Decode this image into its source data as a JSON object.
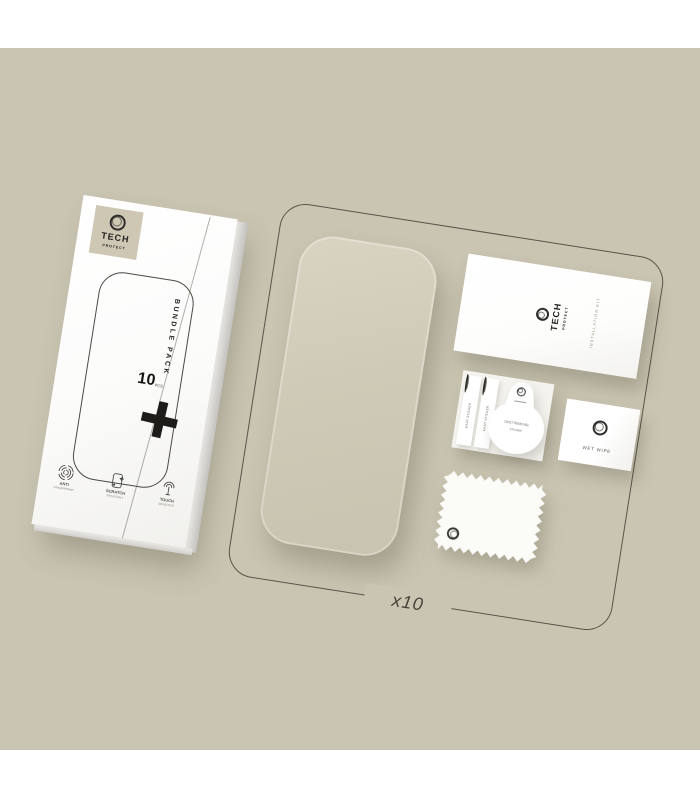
{
  "colors": {
    "background": "#cac5b2",
    "outline": "#56554b",
    "ink": "#23221e",
    "box_logo_square": "#cdc7b4"
  },
  "brand": {
    "top": "TECH",
    "bottom": "PROTECT"
  },
  "box": {
    "bundle_text": "BUNDLE PACK",
    "quantity": "10",
    "quantity_unit": "PCS",
    "features": [
      {
        "icon": "fingerprint-icon",
        "line1": "ANTI",
        "line2": "FINGERPRINT"
      },
      {
        "icon": "screen-sparkle-icon",
        "line1": "SCRATCH",
        "line2": "RESISTANT"
      },
      {
        "icon": "touch-icon",
        "line1": "TOUCH",
        "line2": "SENSITIVE"
      }
    ]
  },
  "kit": {
    "leaflet_side_text": "INSTALLATION KIT",
    "easy_sticker_label": "EASY STICKER",
    "dust_sticker": {
      "line1": "DUST REMOVAL",
      "line2": "STICKER"
    },
    "wet_wipe_label": "WET WIPE",
    "quantity_label": "x10"
  }
}
